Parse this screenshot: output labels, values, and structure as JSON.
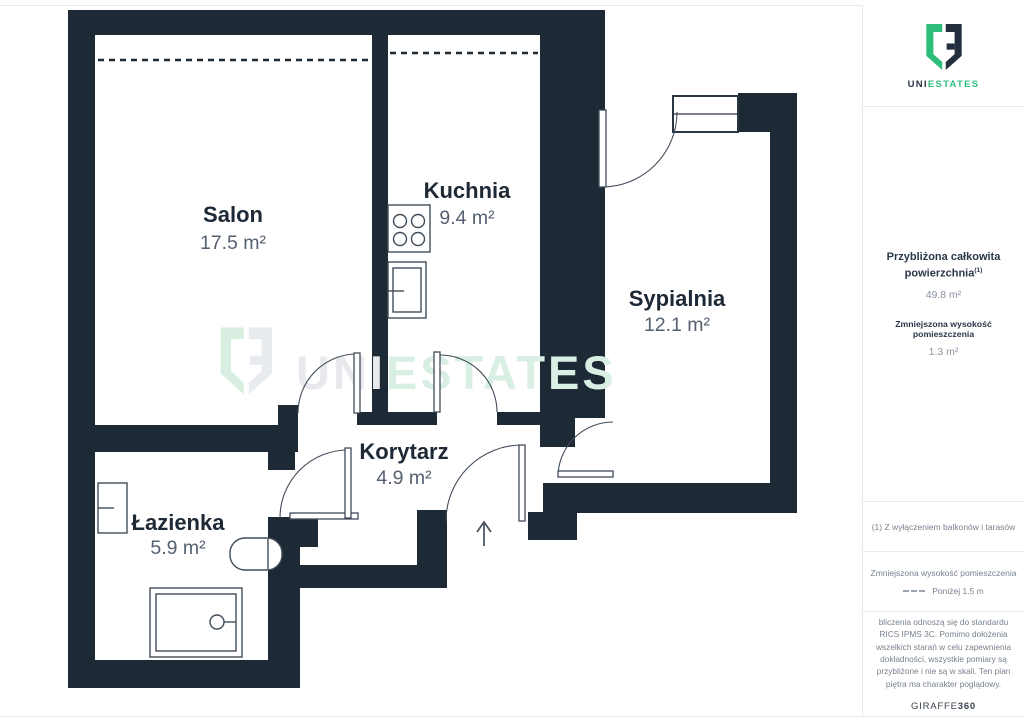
{
  "colors": {
    "wall": "#1e2936",
    "accent_green": "#2fbe7a",
    "label_gray": "#556070"
  },
  "plan": {
    "rooms": [
      {
        "name": "Salon",
        "area": "17.5 m²"
      },
      {
        "name": "Kuchnia",
        "area": "9.4 m²"
      },
      {
        "name": "Sypialnia",
        "area": "12.1 m²"
      },
      {
        "name": "Korytarz",
        "area": "4.9 m²"
      },
      {
        "name": "Łazienka",
        "area": "5.9 m²"
      }
    ],
    "watermark": {
      "prefix": "UNI",
      "suffix": "ESTATES"
    }
  },
  "sidebar": {
    "logo": {
      "prefix": "UNI",
      "suffix": "ESTATES"
    },
    "summary": {
      "title_line1": "Przybliżona całkowita",
      "title_line2": "powierzchnia",
      "footnote_marker": "(1)",
      "total_area": "49.8 m²",
      "reduced_title": "Zmniejszona wysokość pomieszczenia",
      "reduced_value": "1.3 m²"
    },
    "note": "(1) Z wyłączeniem balkonów i tarasów",
    "legend": {
      "title": "Zmniejszona wysokość pomieszczenia",
      "label": "Poniżej 1.5 m"
    },
    "disclaimer": "bliczenia odnoszą się do standardu RICS IPMS 3C. Pomimo dołożenia wszelkich starań w celu zapewnienia dokładności, wszystkie pomiary są przybliżone i nie są w skali. Ten plan piętra ma charakter poglądowy.",
    "brand": {
      "name": "GIRAFFE",
      "suffix": "360"
    }
  }
}
